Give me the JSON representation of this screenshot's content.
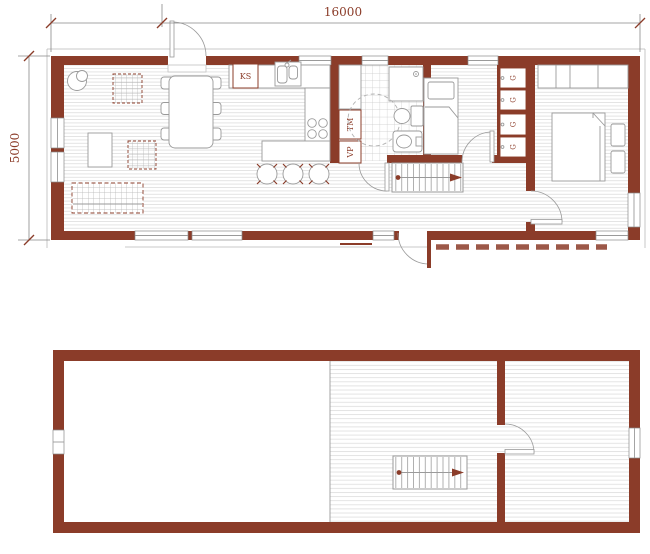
{
  "drawing": {
    "kind": "architectural floor plan, two levels",
    "floors": [
      "first-floor",
      "second-floor-loft"
    ]
  },
  "dimensions": {
    "width": "16000",
    "height": "5000"
  },
  "labels": {
    "fridge": "KS",
    "washing_machine": "TM",
    "water_heater": "VP",
    "wardrobe": "G"
  },
  "colors": {
    "wall": "#8b3c29",
    "annotation_text": "#8b3c29",
    "outline": "#9a9a9a",
    "floor_hatch": "#e1e1e1"
  }
}
